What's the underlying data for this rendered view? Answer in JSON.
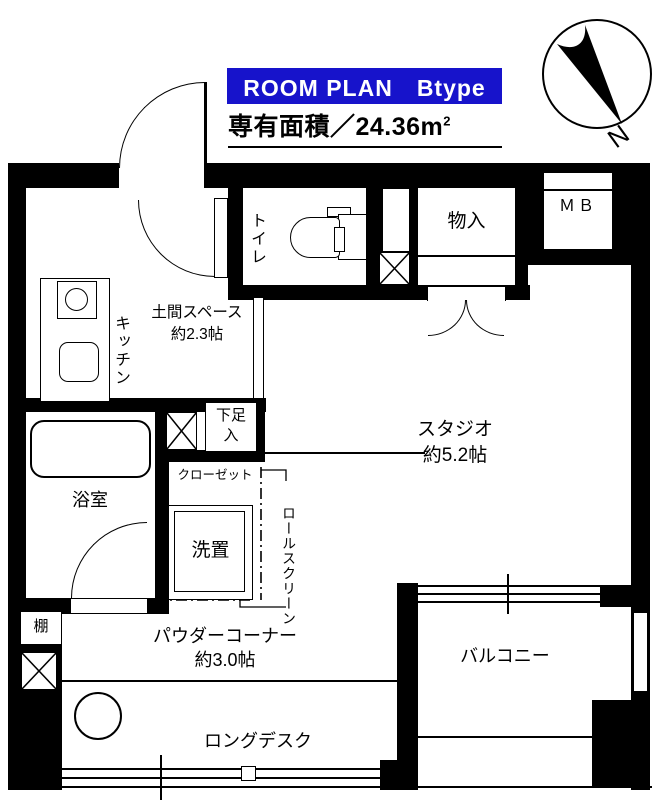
{
  "header": {
    "title": "ROOM PLAN　Btype",
    "area_prefix": "専有面積／24.36m",
    "area_sup": "2"
  },
  "compass": {
    "north_label": "N"
  },
  "rooms": {
    "toilet": "トイレ",
    "storage": "物入",
    "meter_box": "ＭＢ",
    "kitchen": "キッチン",
    "doma": {
      "name": "土間スペース",
      "size": "約2.3帖"
    },
    "studio": {
      "name": "スタジオ",
      "size": "約5.2帖"
    },
    "shoe_storage": "下足入",
    "closet": "クローゼット",
    "bathroom": "浴室",
    "laundry": "洗置",
    "roll_screen": "ロールスクリーン",
    "shelf": "棚",
    "powder_corner": {
      "name": "パウダーコーナー",
      "size": "約3.0帖"
    },
    "long_desk": "ロングデスク",
    "balcony": "バルコニー"
  },
  "colors": {
    "accent_blue": "#1713cb",
    "wall": "#000000"
  }
}
